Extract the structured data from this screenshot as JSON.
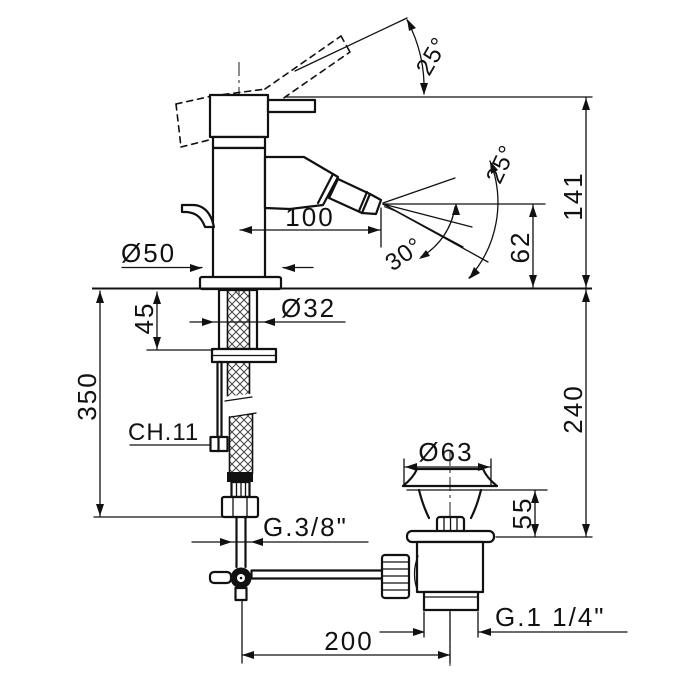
{
  "colors": {
    "line": "#111111",
    "background": "#ffffff"
  },
  "labels": {
    "handle_angle": "25°",
    "spray_tilt_angle": "25°",
    "spray_cone_angle": "30°",
    "height_to_top": "141",
    "spray_height": "62",
    "spout_reach": "100",
    "body_diameter": "Ø50",
    "shank_diameter": "Ø32",
    "shank_depth": "45",
    "hose_length": "350",
    "rod_wrench_size": "CH.11",
    "under_deck_depth": "240",
    "waste_cap_diameter": "Ø63",
    "waste_height": "55",
    "inlet_thread": "G.3/8\"",
    "waste_thread": "G.1 1/4\"",
    "drain_offset": "200"
  }
}
